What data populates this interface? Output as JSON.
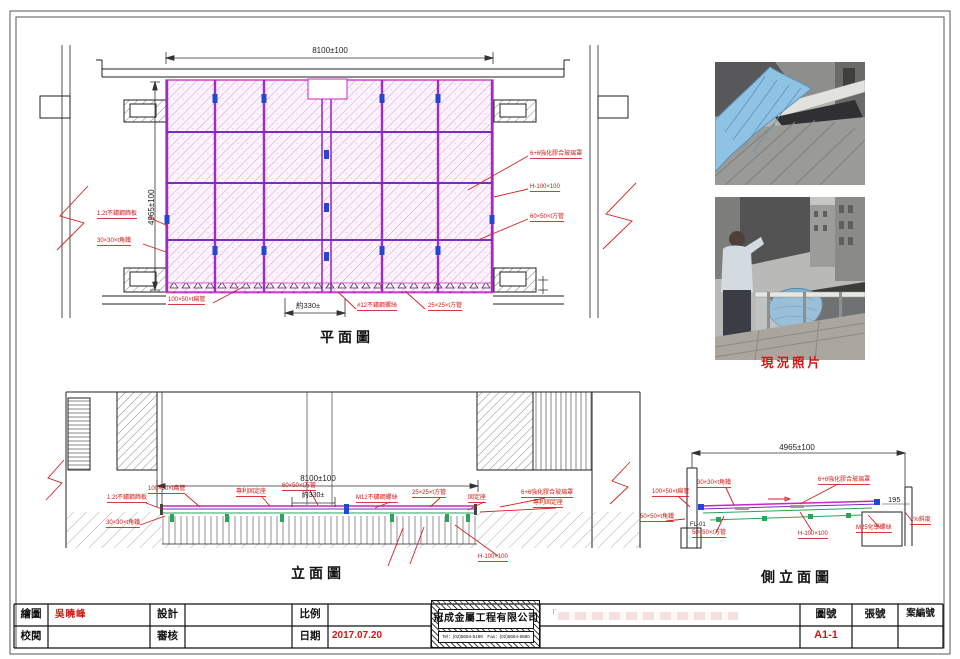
{
  "sheet": {
    "plan": {
      "title": "平面圖",
      "dim_width": "8100±100",
      "dim_height": "4965±100",
      "dim_gap": "約330±",
      "labels_left": [
        "1.2t不鏽鋼飾板",
        "30×30×t角鐵"
      ],
      "labels_right": [
        "6+6強化膠合玻璃罩",
        "H-100×100",
        "60×50×t方管"
      ],
      "labels_bottom": [
        "100×50×t扁管",
        "#12不鏽鋼螺絲",
        "25×25×t方管"
      ]
    },
    "photos": {
      "caption": "現況照片"
    },
    "elevation": {
      "title": "立面圖",
      "dim_width": "8100±100",
      "dim_gap": "約330±",
      "labels": [
        "1.2t不鏽鋼飾板",
        "100×50×t扁管",
        "專利固定座",
        "60×50×t方管",
        "M12不鏽鋼螺絲",
        "25×25×t方管",
        "固定座",
        "6+6強化膠合玻璃罩",
        "專利固定座",
        "30×30×t角鐵",
        "H-100×100"
      ]
    },
    "side_elevation": {
      "title": "側立面圖",
      "dim_width": "4965±100",
      "dim_height": "195",
      "labels": [
        "30×30×t角鐵",
        "100×50×t扁管",
        "50×50×t角鐵",
        "FL-01",
        "50×50×t方管",
        "6+6強化膠合玻璃罩",
        "H-100×100",
        "M25化學螺絲",
        "1%斜度"
      ]
    },
    "title_block": {
      "drawn_by_label": "繪圖",
      "drawn_by": "吳曉峰",
      "checked_label": "校閱",
      "checked": "",
      "design_label": "設計",
      "design": "",
      "review_label": "審核",
      "review": "",
      "scale_label": "比例",
      "scale": "",
      "date_label": "日期",
      "date": "2017.07.20",
      "company_name": "冠成金屬工程有限公司",
      "company_contact": "Tel：(02)8684-6189　Fax：(02)8684-6680",
      "project_quote": "「",
      "drawing_no_label": "圖號",
      "drawing_no": "A1-1",
      "sheet_no_label": "張號",
      "sheet_no": "",
      "case_no_label": "案編號",
      "case_no": ""
    },
    "colors": {
      "annotation_red": "#cf1717",
      "hatch_magenta": "#cc22cc",
      "mullion_purple": "#7a2ebc",
      "clip_blue": "#2546d2",
      "edge_green": "#2aa45a"
    }
  }
}
